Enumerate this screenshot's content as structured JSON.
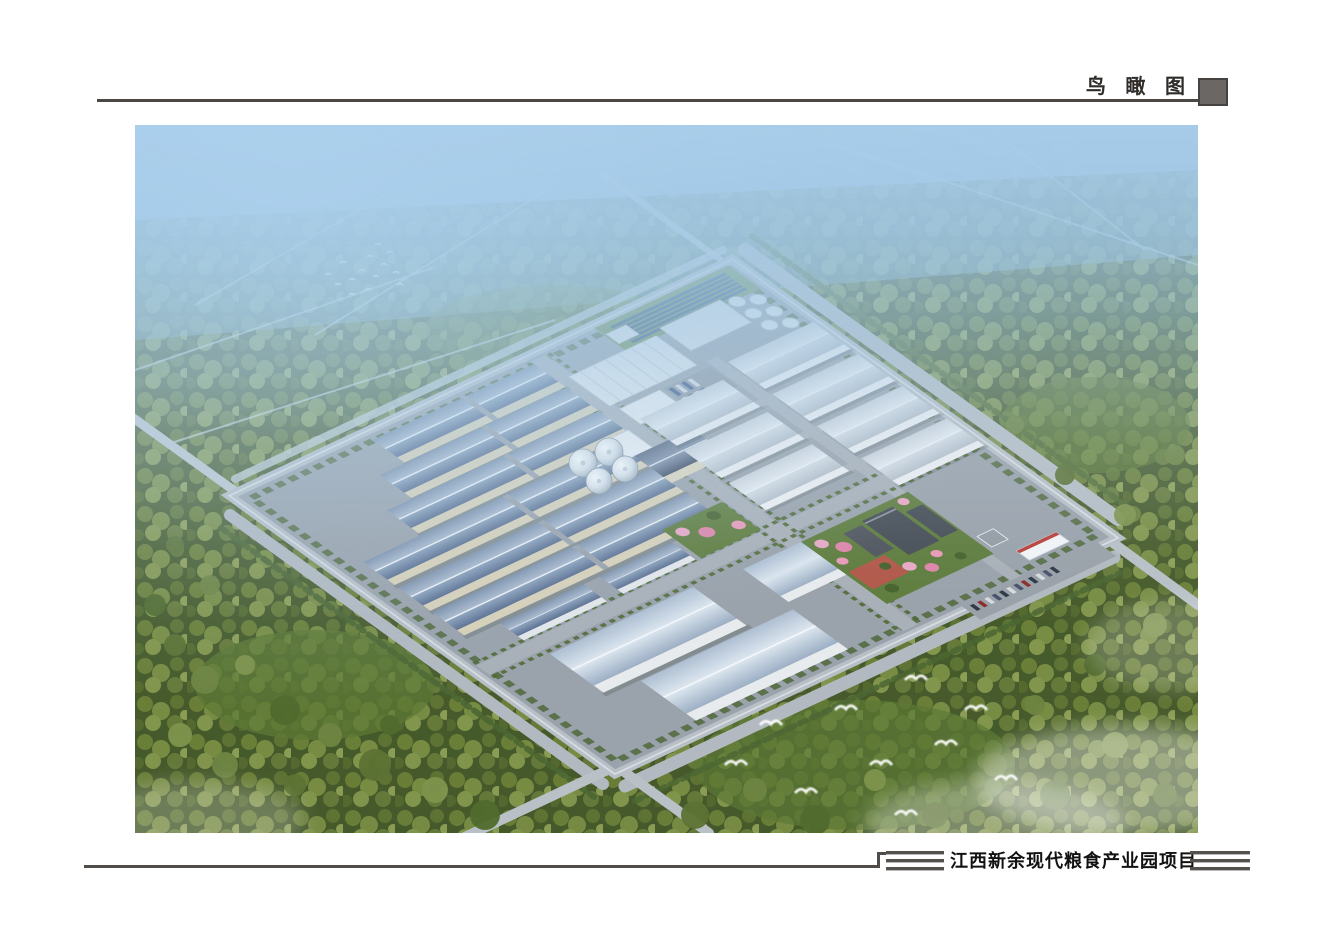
{
  "header": {
    "label": "鸟 瞰 图",
    "rule_color": "#4b4744",
    "square_color": "#6b6764",
    "square_border_color": "#454240"
  },
  "footer": {
    "label": "江西新余现代粮食产业园项目",
    "stripe_color": "#55514d",
    "rule_color": "#504c49"
  },
  "rendering": {
    "kind": "aerial-perspective-rendering",
    "palette": {
      "sky_haze": "#a6cce8",
      "forest_dark": "#45592a",
      "forest_light": "#7b8f45",
      "pavement": "#9aa2ab",
      "warehouse_roof_blue": "#64789b",
      "warehouse_wall_cream": "#d9d1b8",
      "warehouse_roof_white": "#e2e7ec",
      "lawn_green": "#6d8c49",
      "solar_panel_blue": "#2c4d80",
      "blossom_pink": "#e8a9c5",
      "plaza_red": "#b2584a",
      "bird_white": "#ffffff"
    }
  }
}
